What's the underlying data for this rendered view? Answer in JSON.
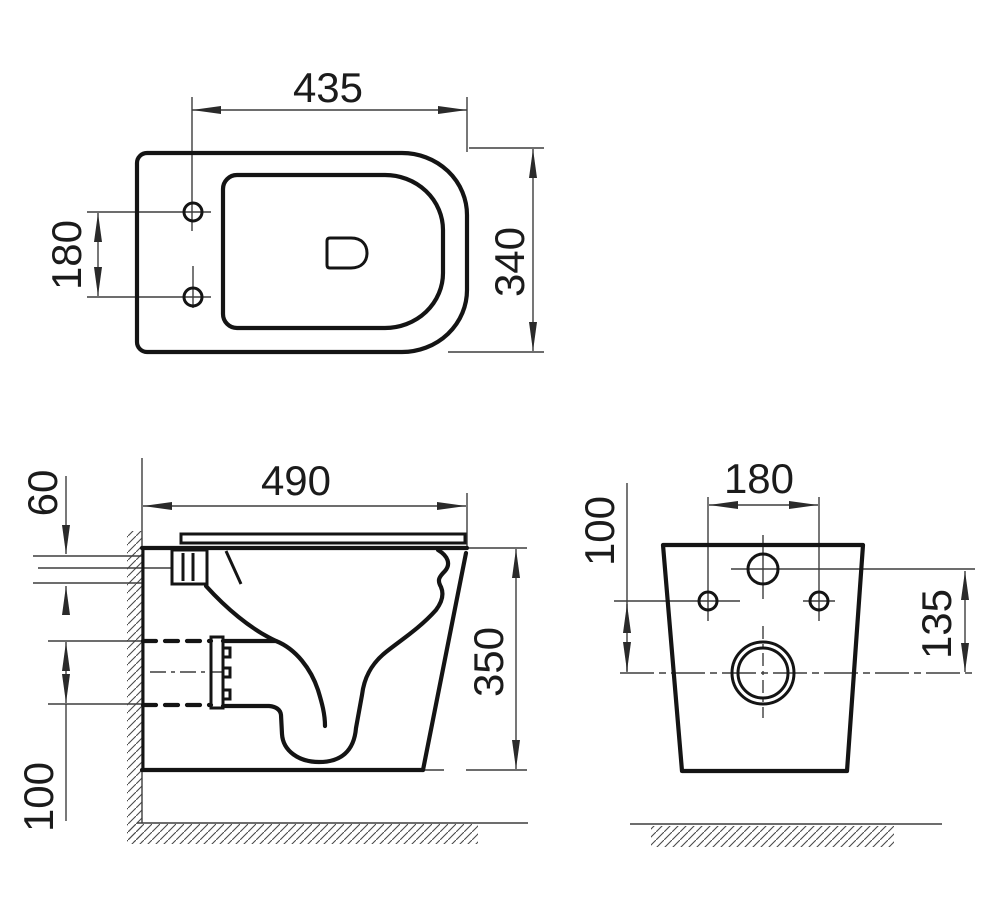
{
  "drawing": {
    "background": "#ffffff",
    "line_color": "#141414",
    "thin_line_color": "#3d3d3d",
    "text_color": "#1b1b1b"
  },
  "views": {
    "top": {
      "dims": {
        "overall_width": "435",
        "overall_depth": "340",
        "mount_hole_spacing": "180"
      }
    },
    "side": {
      "dims": {
        "top_offset": "60",
        "overall_depth": "490",
        "drain_size": "100",
        "body_height": "350"
      }
    },
    "rear": {
      "dims": {
        "mount_hole_spacing": "180",
        "hole_to_outlet": "100",
        "inlet_to_outlet": "135"
      }
    }
  }
}
